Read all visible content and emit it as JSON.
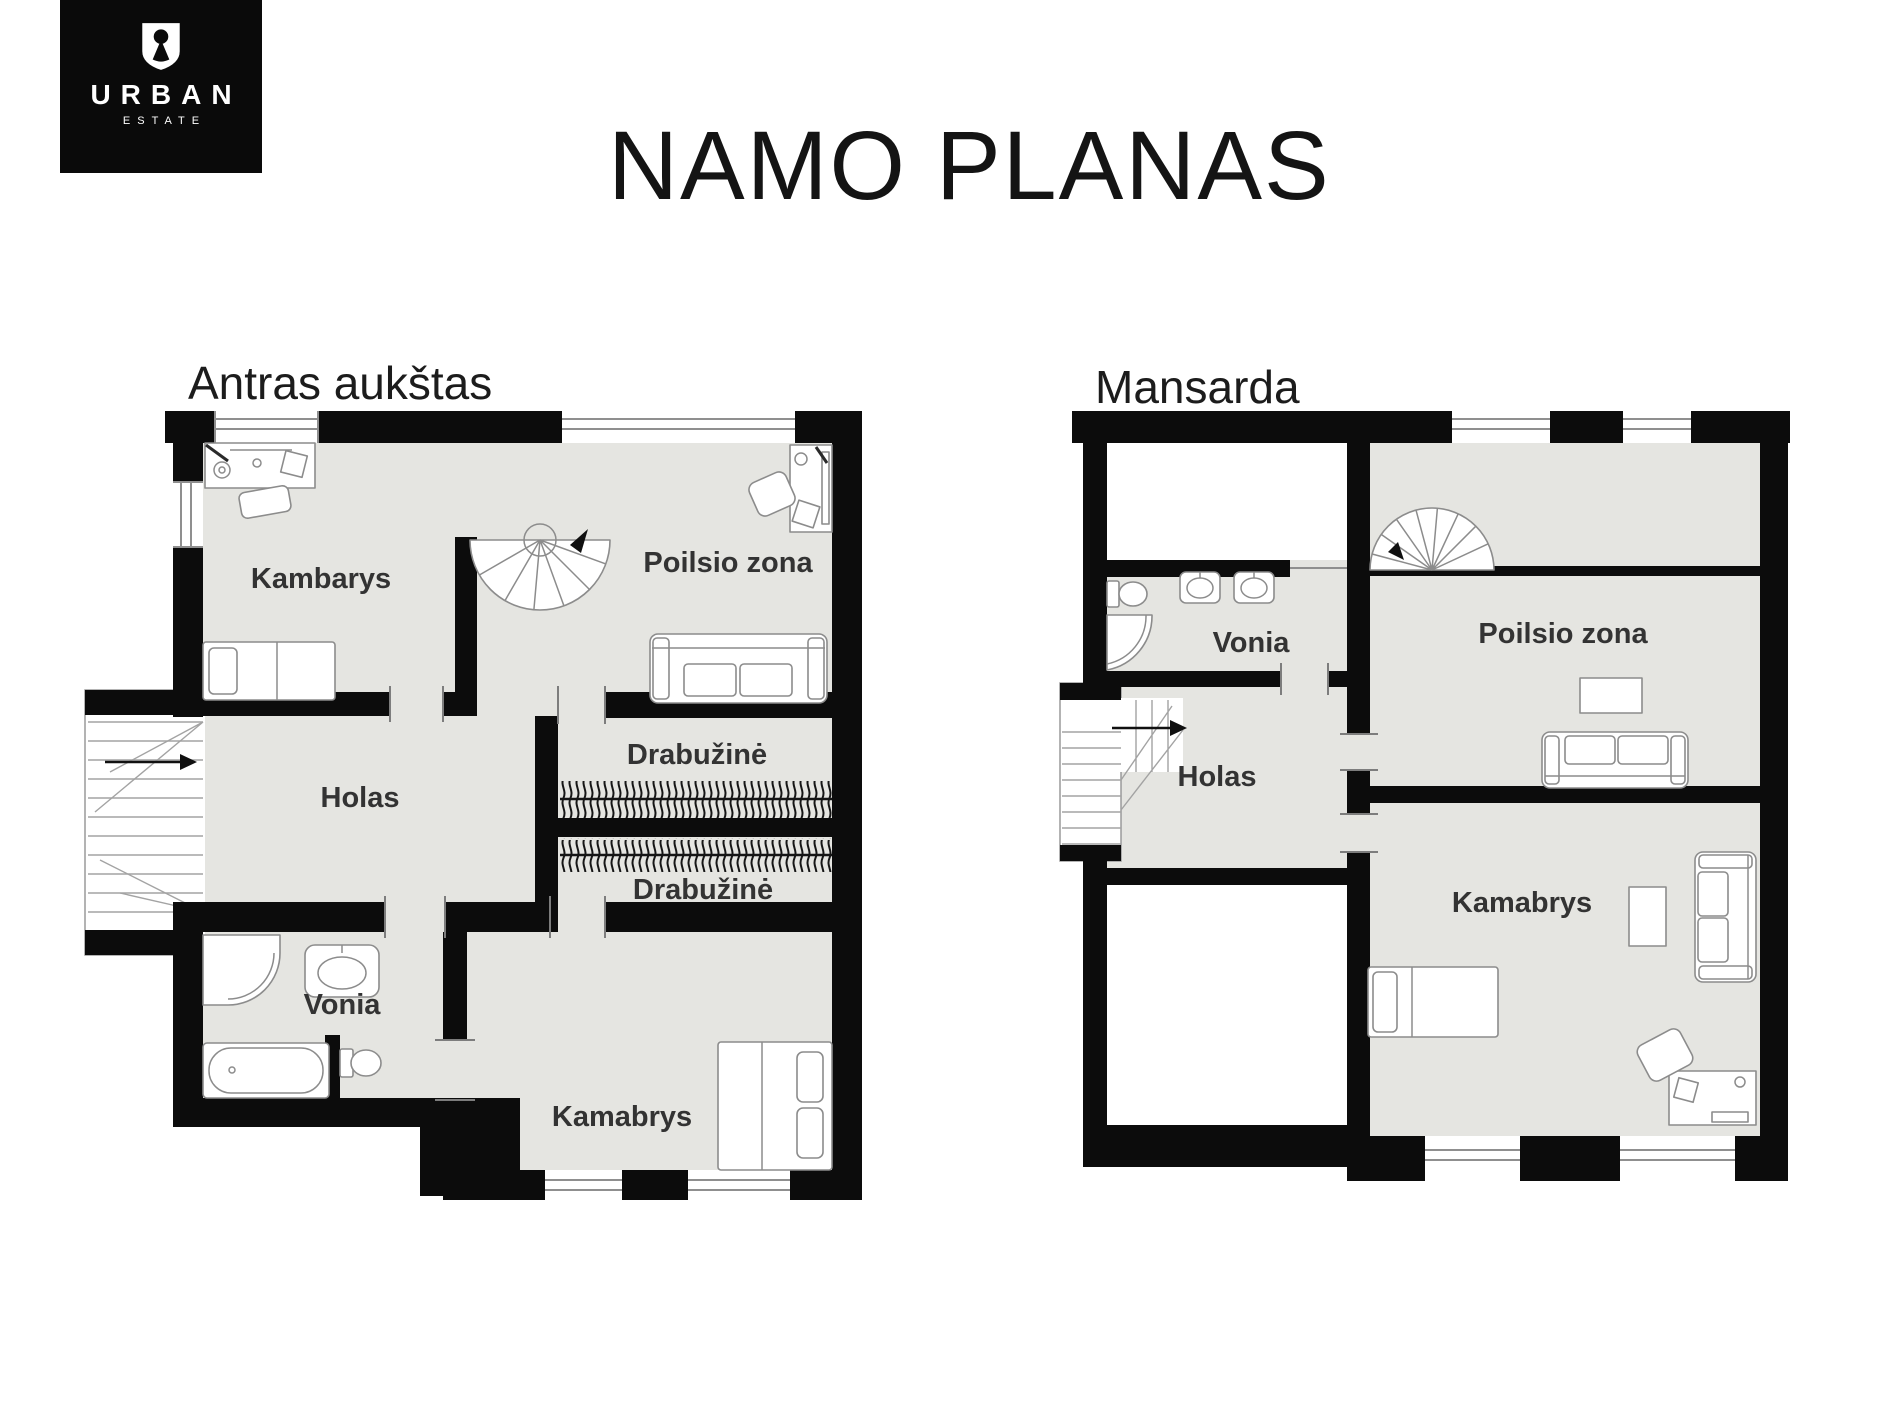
{
  "title": "NAMO PLANAS",
  "logo": {
    "brand": "URBAN",
    "sub": "ESTATE",
    "icon": "keyhole-shield-icon"
  },
  "plans": [
    {
      "name": "Antras aukštas",
      "rooms": [
        "Kambarys",
        "Poilsio zona",
        "Holas",
        "Drabužinė",
        "Drabužinė",
        "Vonia",
        "Kamabrys"
      ]
    },
    {
      "name": "Mansarda",
      "rooms": [
        "Vonia",
        "Poilsio zona",
        "Holas",
        "Kamabrys"
      ]
    }
  ],
  "colors": {
    "background": "#ffffff",
    "wall": "#0c0c0c",
    "floor": "#e5e5e1",
    "furniture_outline": "#8c8c8c",
    "label": "#333333",
    "logo_bg": "#0a0a0a",
    "logo_fg": "#ffffff"
  }
}
